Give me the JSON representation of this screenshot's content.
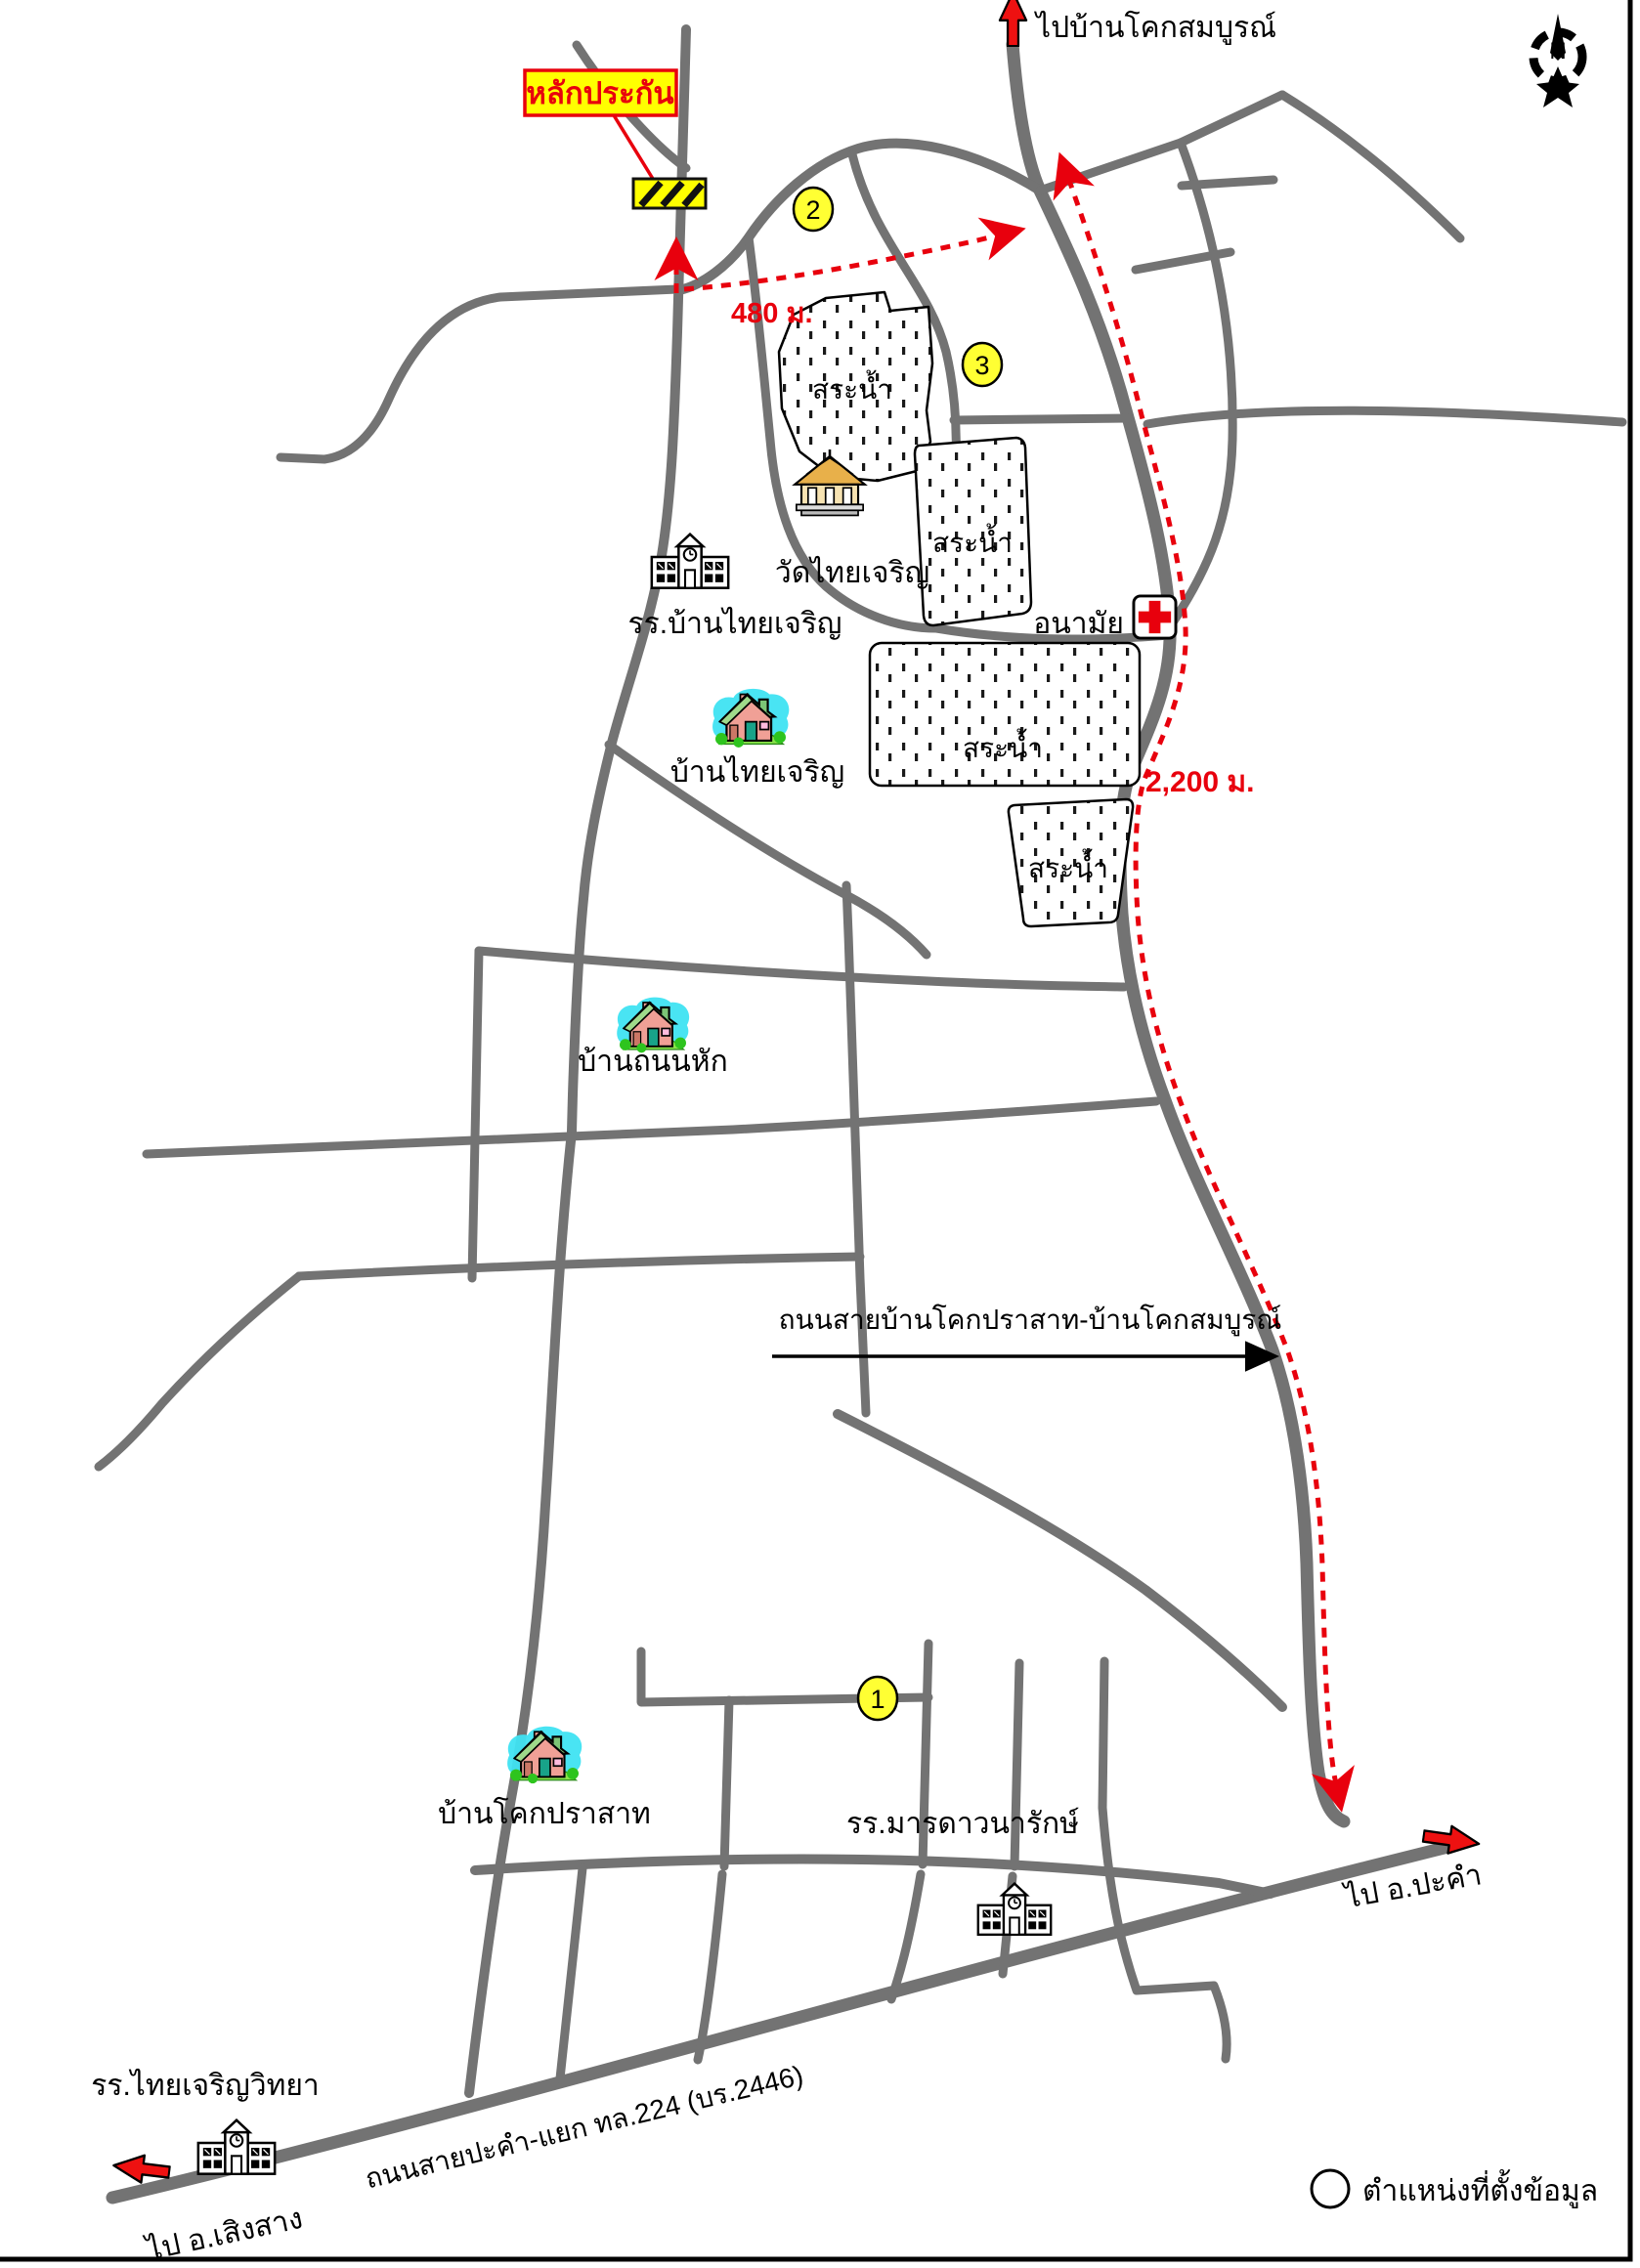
{
  "compass": {
    "letter": "N"
  },
  "collateral_box": {
    "label": "หลักประกัน"
  },
  "distances": {
    "to_junction": "480 ม.",
    "along_main_road": "2,200 ม."
  },
  "exits": {
    "north": "ไปบ้านโคกสมบูรณ์",
    "east": "ไป อ.ปะคำ",
    "southwest": "ไป อ.เสิงสาง"
  },
  "road_names": {
    "cross_road": "ถนนสายบ้านโคกปราสาท-บ้านโคกสมบูรณ์",
    "highway": "ถนนสายปะคำ-แยก ทล.224 (บร.2446)"
  },
  "places": {
    "temple": {
      "label": "วัดไทยเจริญ"
    },
    "school_banthaicharoen": {
      "label": "รร.บ้านไทยเจริญ"
    },
    "health_center": {
      "label": "อนามัย"
    },
    "village_thaicharoen": {
      "label": "บ้านไทยเจริญ"
    },
    "village_thanonhak": {
      "label": "บ้านถนนหัก"
    },
    "village_khokprasat": {
      "label": "บ้านโคกปราสาท"
    },
    "school_mardawanarak": {
      "label": "รร.มารดาวนารักษ์"
    },
    "school_thaicharoenwittaya": {
      "label": "รร.ไทยเจริญวิทยา"
    }
  },
  "ponds": [
    "สระน้ำ",
    "สระน้ำ",
    "สระน้ำ",
    "สระน้ำ"
  ],
  "route_markers": [
    "1",
    "2",
    "3"
  ],
  "legend": {
    "label": "ตำแหน่งที่ตั้งข้อมูล"
  },
  "colors": {
    "road": "#737373",
    "route_red": "#e8000d",
    "highlight_yellow": "#ffff00",
    "marker_yellow": "#ffff33",
    "house_halo": "#3fe3f2",
    "roof_green": "#7cc576",
    "house_pink": "#f0a096",
    "temple_gold": "#e8b04a"
  }
}
